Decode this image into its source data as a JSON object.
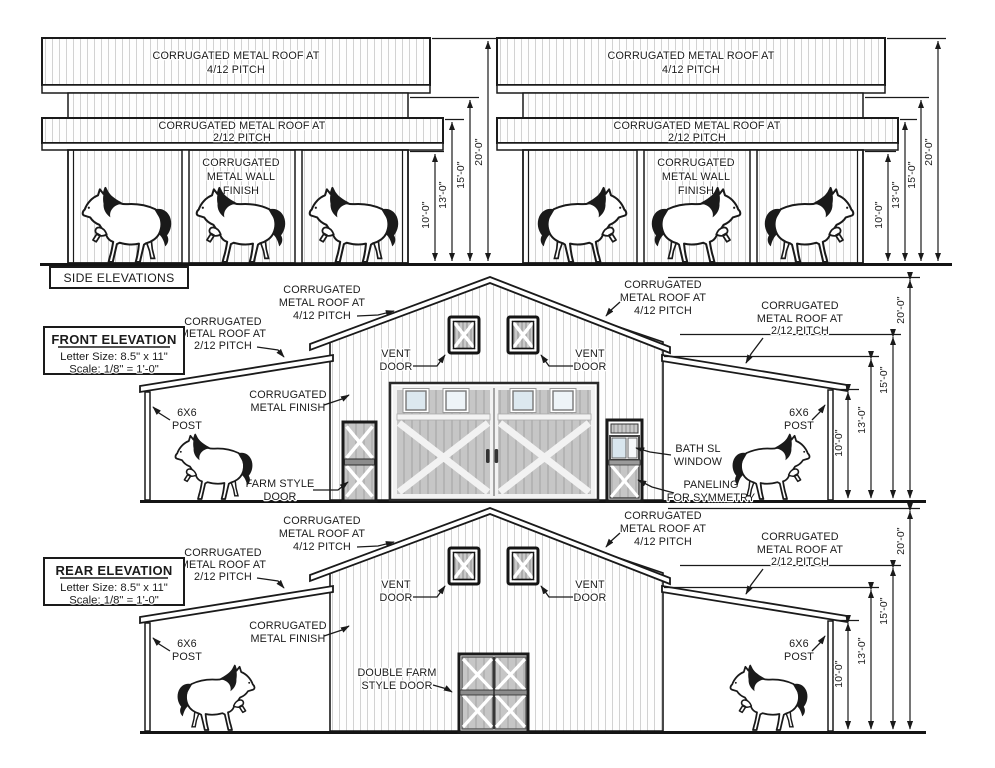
{
  "side": {
    "title": "SIDE ELEVATIONS",
    "roof_upper_l1": "CORRUGATED METAL ROOF AT",
    "roof_upper_l2": "4/12 PITCH",
    "roof_lower_l1": "CORRUGATED METAL ROOF AT",
    "roof_lower_l2": "2/12 PITCH",
    "wall_l1": "CORRUGATED",
    "wall_l2": "METAL WALL",
    "wall_l3": "FINISH"
  },
  "front": {
    "title": "FRONT ELEVATION",
    "letter_size": "Letter Size: 8.5\" x 11\"",
    "scale": "Scale:  1/8\" = 1'-0\"",
    "farm_style_l1": "FARM STYLE",
    "farm_style_l2": "DOOR",
    "bath_l1": "BATH SL",
    "bath_l2": "WINDOW",
    "paneling_l1": "PANELING",
    "paneling_l2": "FOR SYMMETRY"
  },
  "rear": {
    "title": "REAR ELEVATION",
    "letter_size": "Letter Size: 8.5\" x 11\"",
    "scale": "Scale:  1/8\" = 1'-0\"",
    "double_door_l1": "DOUBLE FARM",
    "double_door_l2": "STYLE DOOR"
  },
  "labels": {
    "corrugated": "CORRUGATED",
    "metal_roof_at": "METAL ROOF AT",
    "pitch_4_12": "4/12 PITCH",
    "pitch_2_12": "2/12 PITCH",
    "metal_finish": "METAL FINISH",
    "vent": "VENT",
    "door": "DOOR",
    "post_size": "6X6",
    "post": "POST"
  },
  "dims": {
    "ten": "10'-0\"",
    "thirteen": "13'-0\"",
    "fifteen": "15'-0\"",
    "twenty": "20'-0\""
  },
  "colors": {
    "ink": "#1a1a1a",
    "paper": "#ffffff",
    "siding_line": "#cfcfcf",
    "panel_gray": "#c6c6c6",
    "pane_blue": "#dce8ef"
  }
}
